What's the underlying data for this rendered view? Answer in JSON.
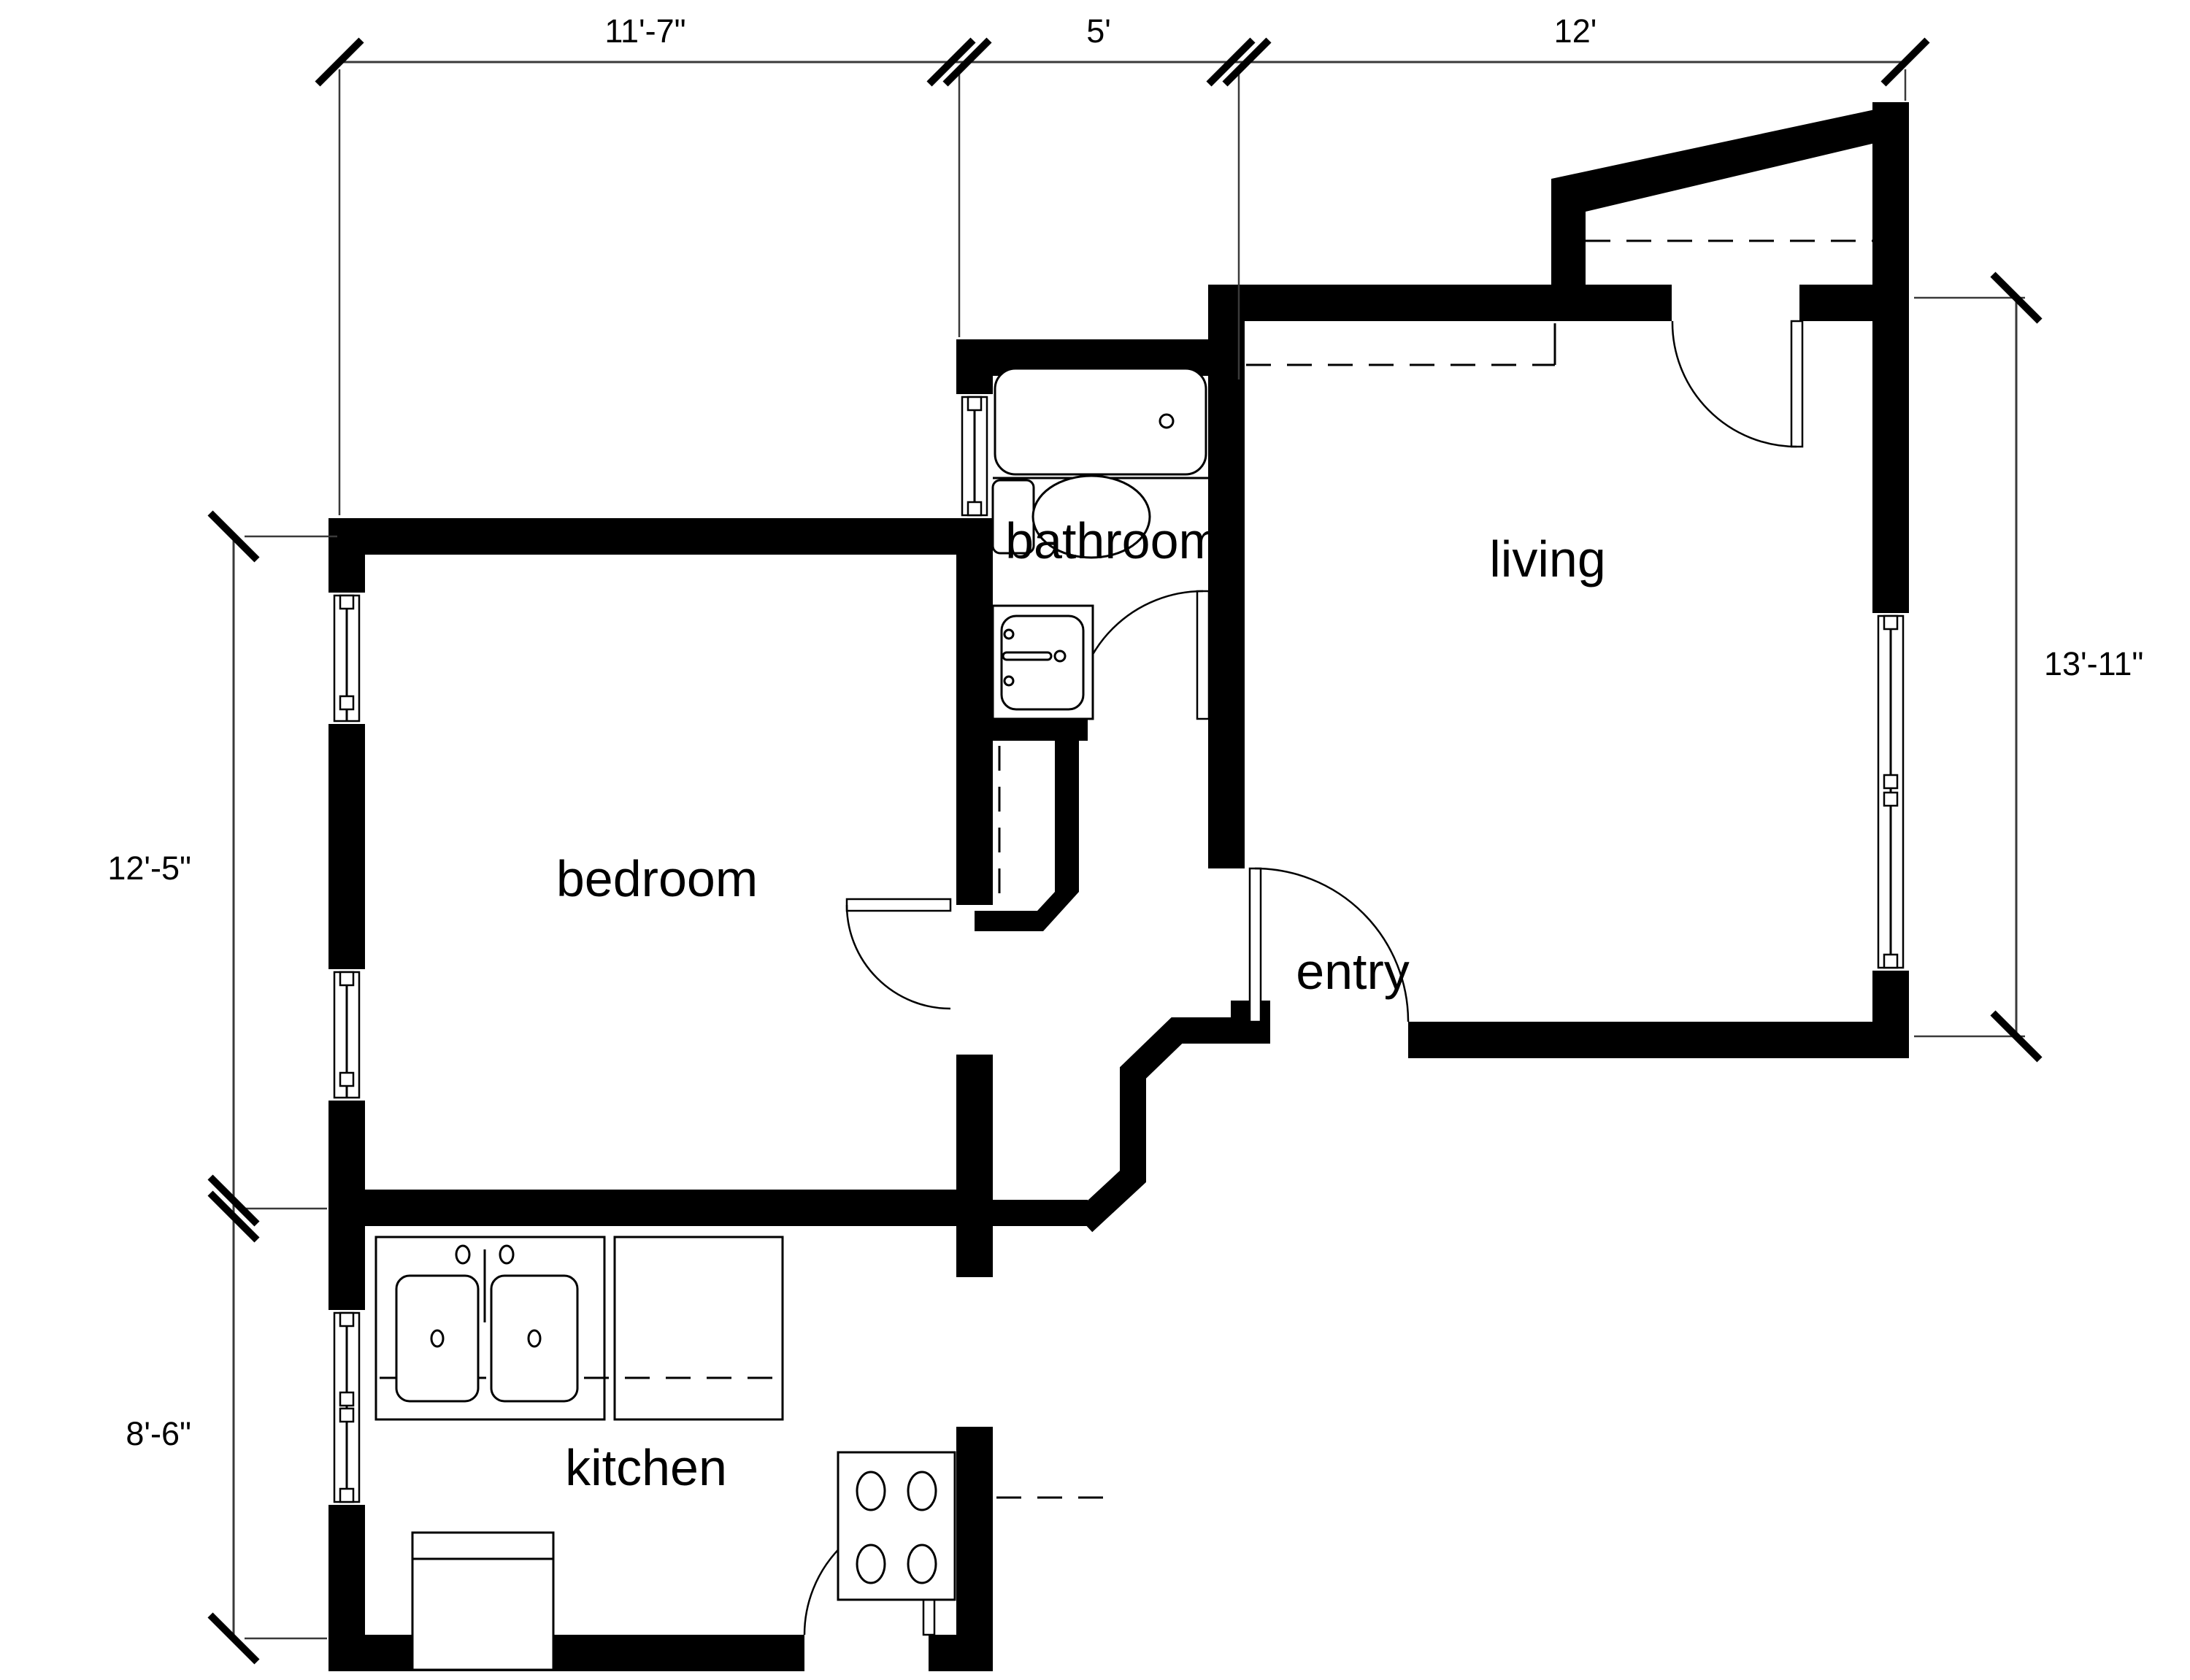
{
  "plan": {
    "type": "apartment floor plan",
    "colors": {
      "wall": "#000000",
      "background": "#ffffff",
      "dimension_line": "#3a3a3a"
    },
    "rooms": [
      {
        "id": "bedroom",
        "label": "bedroom"
      },
      {
        "id": "bathroom",
        "label": "bathroom"
      },
      {
        "id": "living",
        "label": "living"
      },
      {
        "id": "entry",
        "label": "entry"
      },
      {
        "id": "kitchen",
        "label": "kitchen"
      }
    ],
    "dimensions": {
      "top": [
        "11'-7\"",
        "5'",
        "12'"
      ],
      "left": [
        "12'-5\"",
        "8'-6\""
      ],
      "right": [
        "13'-11\""
      ]
    },
    "fixtures": [
      "bathtub",
      "toilet",
      "bathroom-sink",
      "double-kitchen-sink",
      "kitchen-counter",
      "stove-4-burners",
      "refrigerator",
      "closet-rod-dashed",
      "wardrobe-dashed-shelf"
    ]
  }
}
